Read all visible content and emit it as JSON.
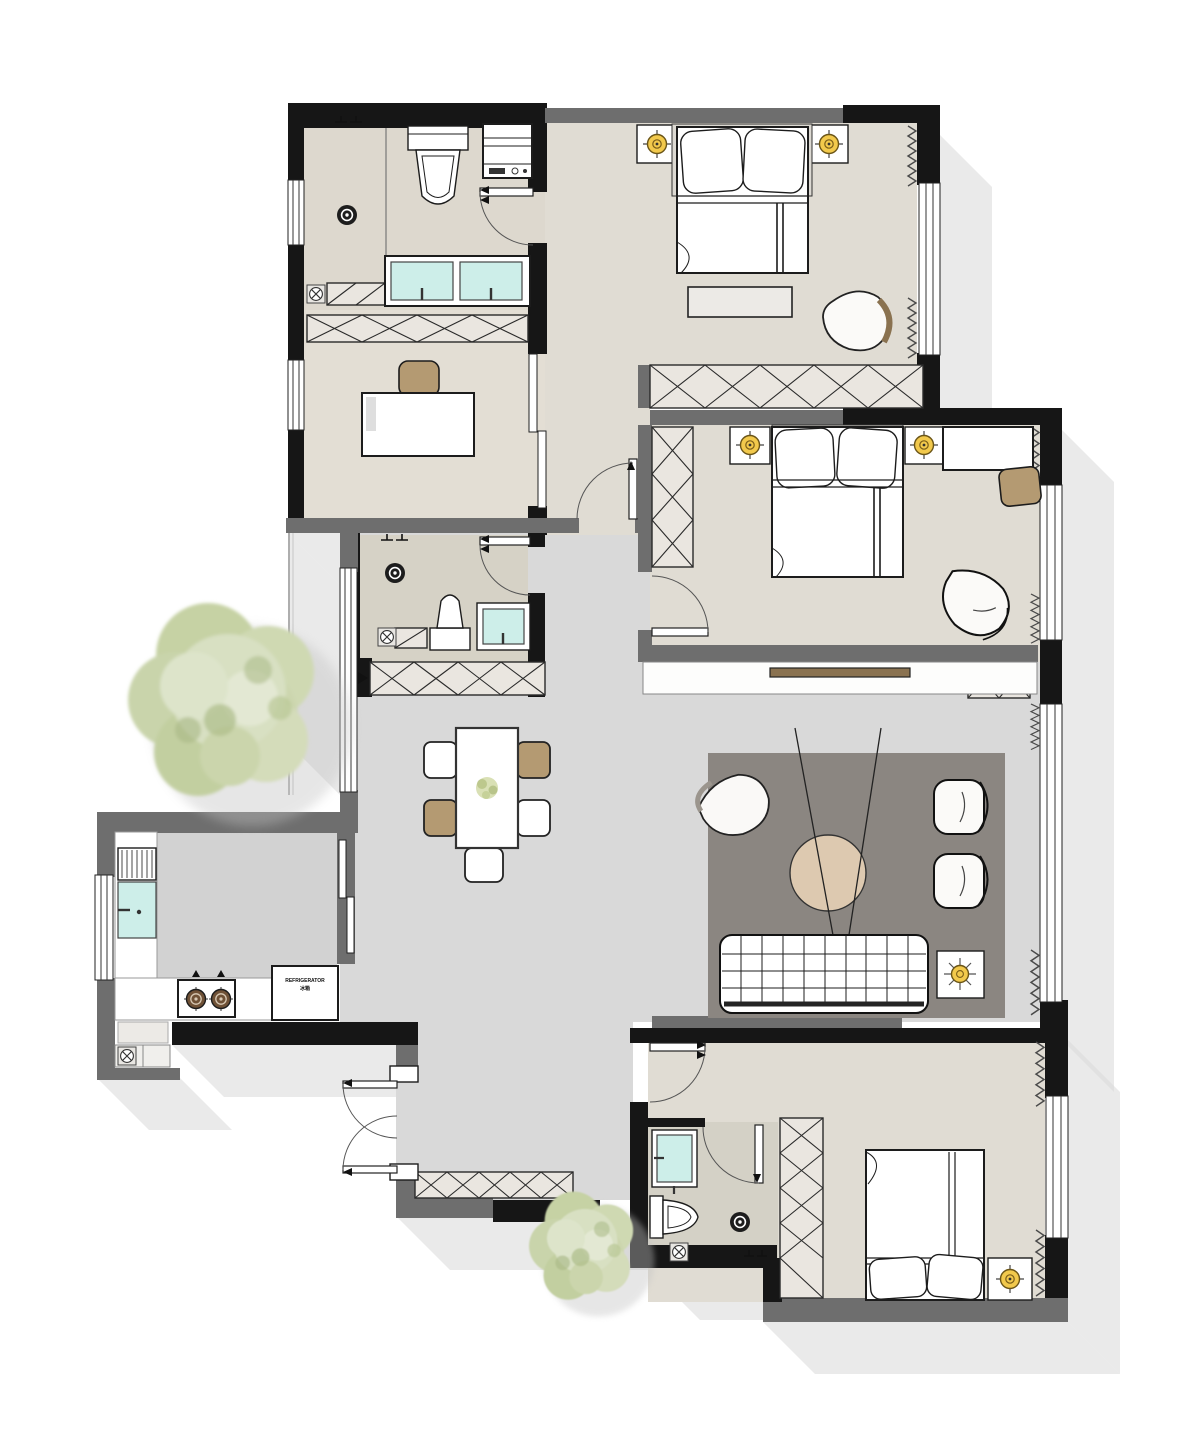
{
  "document": {
    "kind": "residential floor plan, top-down furnished view",
    "visible_text_note": "only visible text is the tiny refrigerator label"
  },
  "labels": {
    "fridge_line1": "REFRIGERATOR",
    "fridge_line2": "冰箱"
  },
  "palette": {
    "exterior_wall": "#161616",
    "interior_wall": "#6e6e6e",
    "bedroom_floor": "#e0dcd3",
    "bathroom_floor": "#d6d2c7",
    "hall_floor": "#d9d9d9",
    "kitchen_floor": "#d2d2d2",
    "living_rug": "#8b8681",
    "furniture_white": "#ffffff",
    "fixture_teal": "#cdeee9",
    "lamp_yellow": "#f2c94c",
    "wood_tan": "#b49a72",
    "leather_brown": "#8a7250",
    "coffee_table_beige": "#ddc9b0",
    "tree_green": "#ccd6ae",
    "drop_shadow": "#d9d9d9"
  },
  "icons": {
    "table-lamp-icon": "yellow circle with crosshair on nightstands",
    "ceiling-light-icon": "yellow sun symbol on side table",
    "floor-drain-icon": "black circle with white ring",
    "drain-box-icon": "circled X inside small square",
    "stove-burner-icon": "brown ring with cross",
    "wardrobe-pattern": "rectangular cells crossed with X",
    "curtain-pattern": "zigzag line",
    "window-pattern": "parallel glazing lines",
    "door-swing": "quarter-circle arc with leaf"
  }
}
